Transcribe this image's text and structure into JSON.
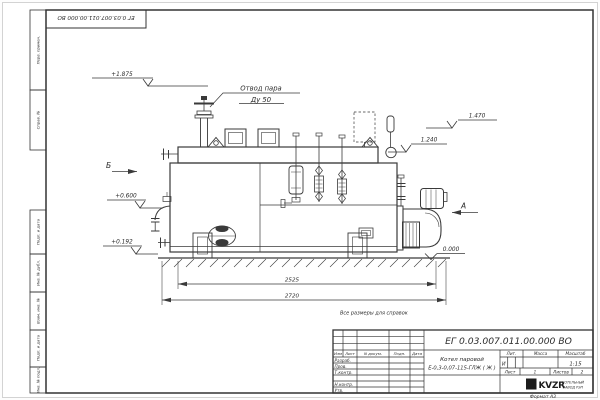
{
  "frame": {
    "top_stamp": "ЕГ 0.03.007.011.00.000  ВО",
    "format_label": "Формат А3",
    "margin_top_cells": [
      "Перв. примен.",
      "Справ. №"
    ],
    "margin_bottom_cells": [
      "Подп. и дата",
      "Инв. № дубл.",
      "Взам. инв. №",
      "Подп. и дата",
      "Инв. № подл."
    ]
  },
  "drawing": {
    "note": "Все размеры для справок",
    "callout": {
      "line1": "Отвод пара",
      "line2": "Ду 50"
    },
    "views": {
      "left": "Б",
      "right": "А"
    },
    "elevations": {
      "valve_top": "+1.875",
      "right_upper": "1.470",
      "right_lower": "1.240",
      "left_upper": "+0.600",
      "left_lower": "+0.192",
      "ground": "0.000"
    },
    "dimensions": {
      "boiler_length": "2525",
      "overall_length": "2720"
    }
  },
  "title_block": {
    "doc_number": "ЕГ 0.03.007.011.00.000  ВО",
    "product_line1": "Котел паровой",
    "product_line2": "Е-0,3-0,07-115-ГЛЖ ( Ж )",
    "col_izm": "Изм",
    "col_list": "Лист",
    "col_doc": "N докум.",
    "col_sign": "Подп.",
    "col_date": "Дата",
    "row_labels": [
      "Разраб.",
      "Пров.",
      "Т.контр.",
      "Н.контр.",
      "Утв."
    ],
    "lit_label": "Лит.",
    "lit_value": "И",
    "mass_label": "Масса",
    "scale_label": "Масштаб",
    "scale_value": "1:15",
    "sheet_label": "Лист",
    "sheet_value": "1",
    "sheets_label": "Листов",
    "sheets_value": "2",
    "logo_text": "KVZR",
    "logo_caption1": "КОТЕЛЬНЫЙ",
    "logo_caption2": "ЗАВОД РЭП"
  }
}
